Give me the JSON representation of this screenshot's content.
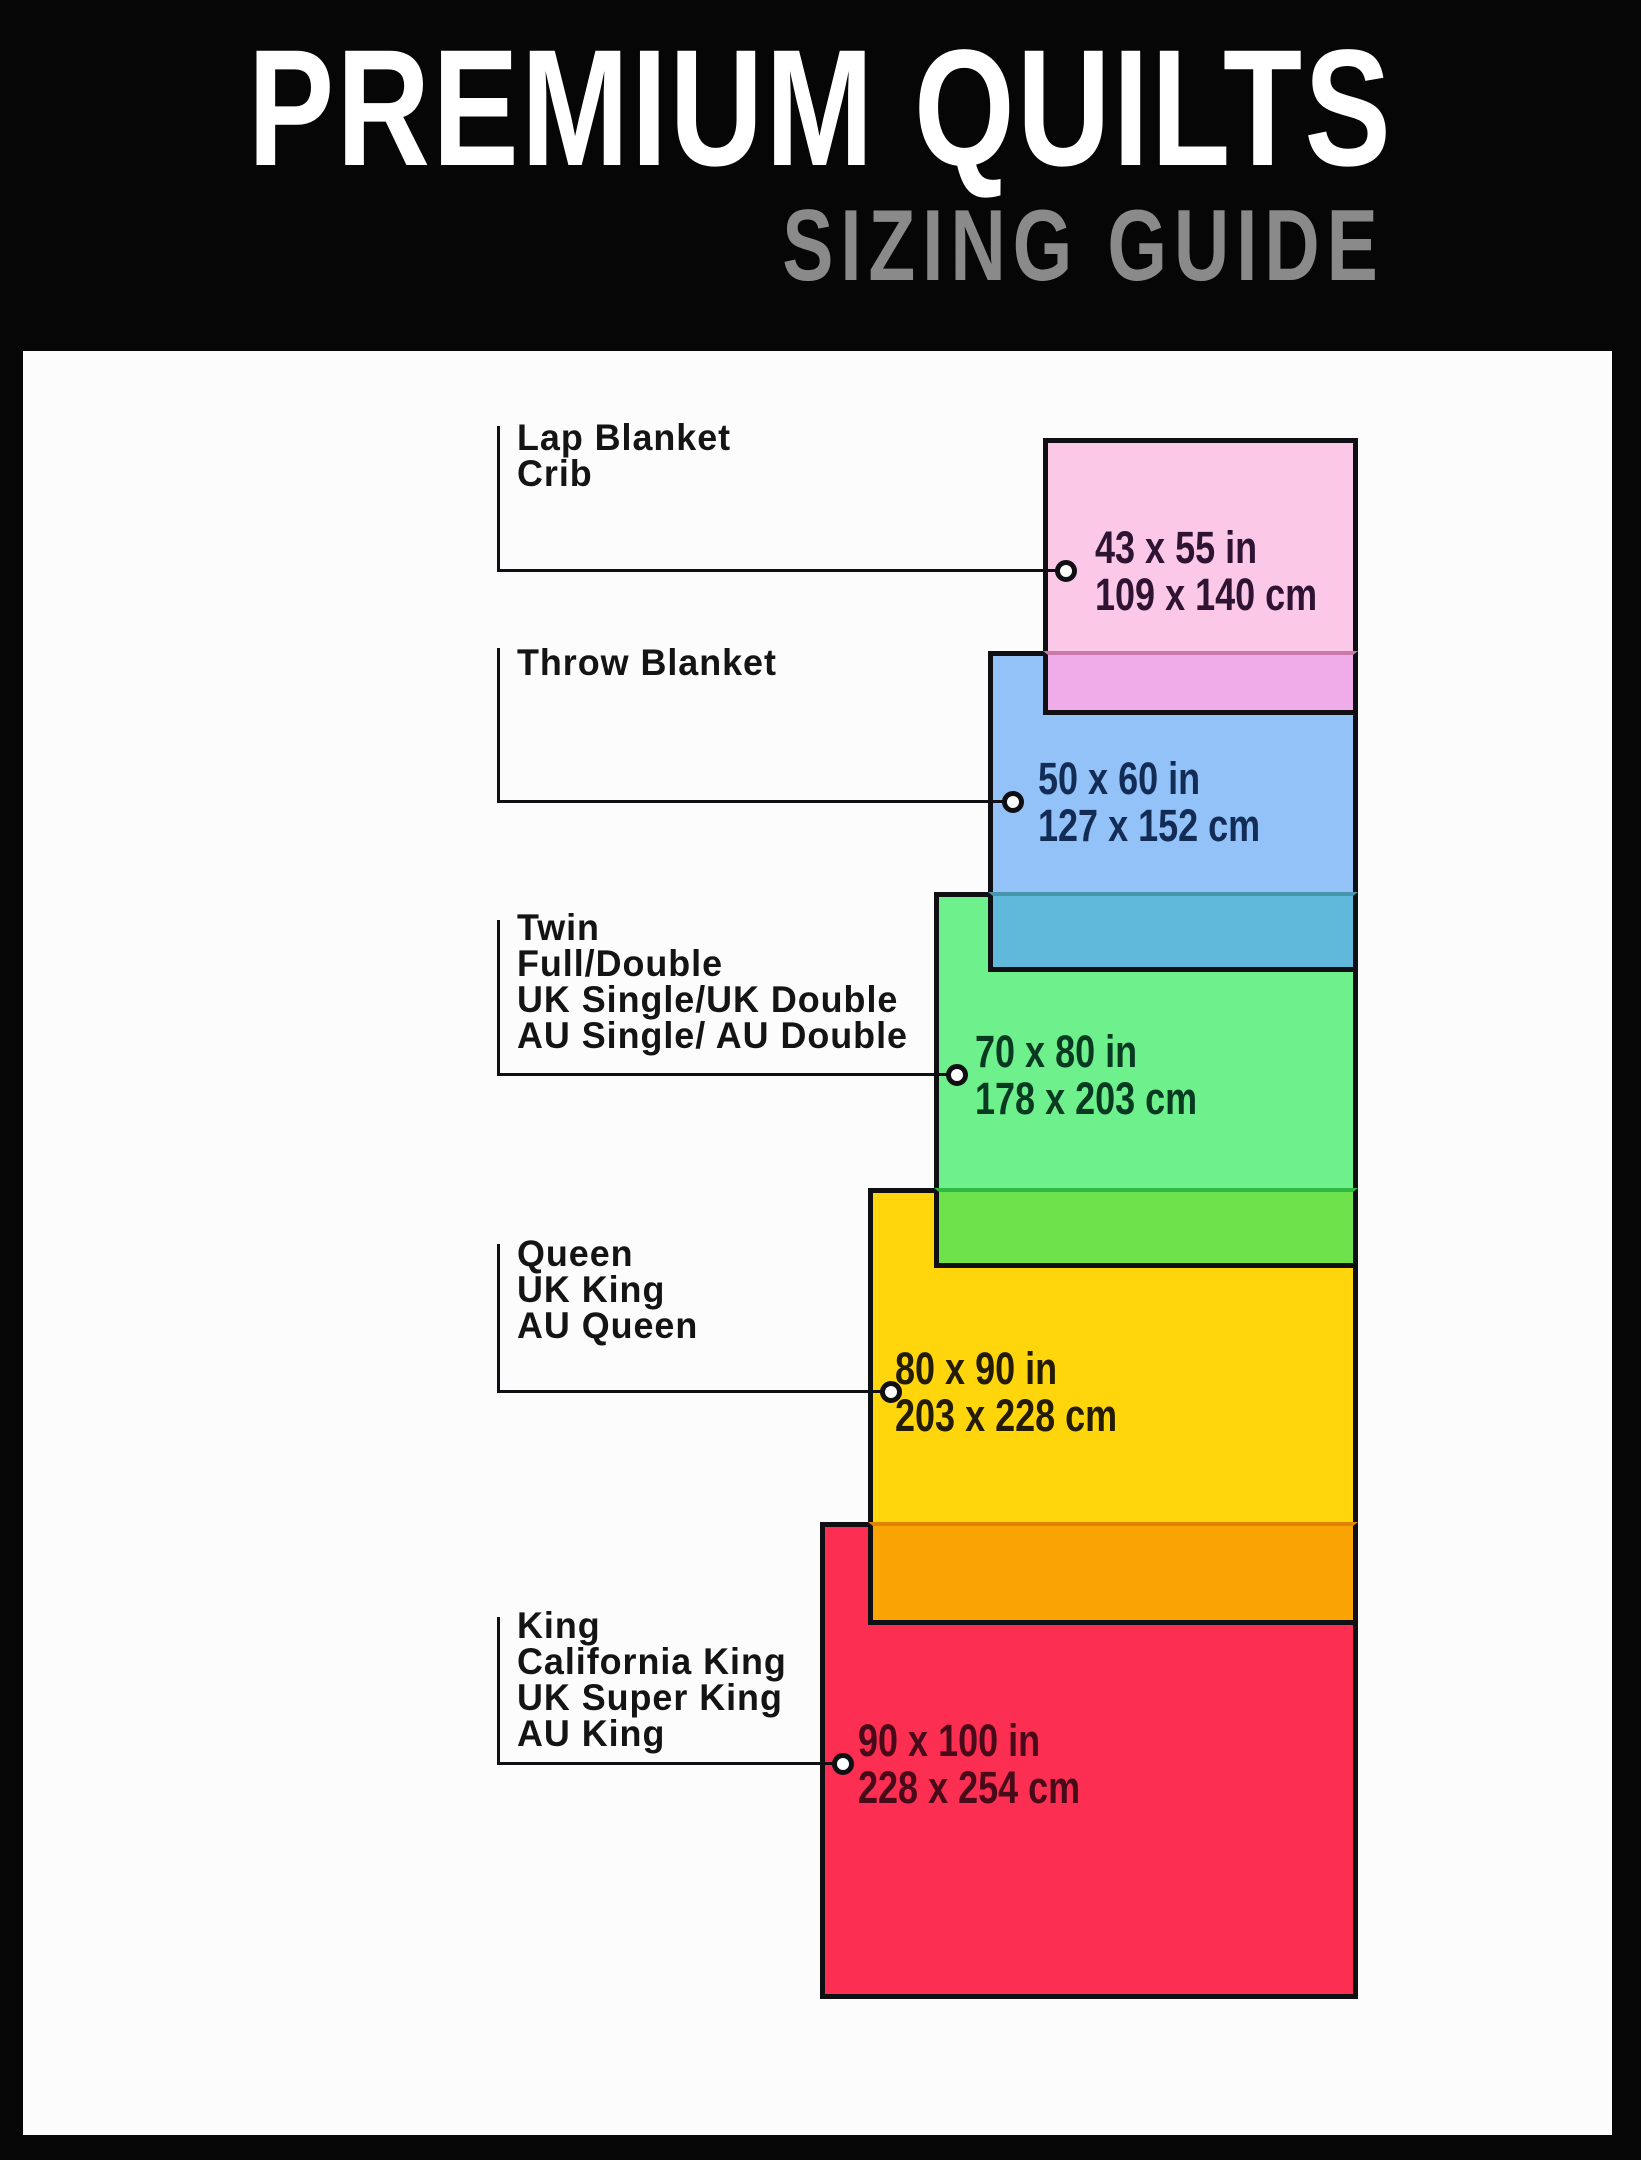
{
  "header": {
    "title": "PREMIUM QUILTS",
    "subtitle": "SIZING GUIDE"
  },
  "colors": {
    "background": "#060606",
    "panel": "#fcfcfc",
    "outline": "#101014",
    "title_text": "#ffffff",
    "subtitle_text": "#8a8a8a",
    "label_text": "#141414"
  },
  "sizes": [
    {
      "names": [
        "Lap Blanket",
        "Crib"
      ],
      "inches": "43 x 55 in",
      "cm": "109 x 140 cm",
      "fill": "#fbc8e7",
      "text_color": "#2f1333"
    },
    {
      "names": [
        "Throw Blanket"
      ],
      "inches": "50 x 60 in",
      "cm": "127 x 152 cm",
      "fill": "#92c2f8",
      "text_color": "#132c55",
      "overlap_fill": "#f0abe9",
      "overlap_line": "#c979ac"
    },
    {
      "names": [
        "Twin",
        "Full/Double",
        "UK Single/UK Double",
        "AU Single/ AU Double"
      ],
      "inches": "70 x 80 in",
      "cm": "178 x 203 cm",
      "fill": "#6ef08d",
      "text_color": "#083a21",
      "overlap_fill": "#60b8da",
      "overlap_line": "#4794ad"
    },
    {
      "names": [
        "Queen",
        "UK King",
        "AU Queen"
      ],
      "inches": "80 x 90 in",
      "cm": "203 x 228 cm",
      "fill": "#ffd60b",
      "text_color": "#231c02",
      "overlap_fill": "#6ee24b",
      "overlap_line": "#2eb944"
    },
    {
      "names": [
        "King",
        "California King",
        "UK Super King",
        "AU King"
      ],
      "inches": "90 x 100 in",
      "cm": "228 x 254 cm",
      "fill": "#fc2e51",
      "text_color": "#470a18",
      "overlap_fill": "#f9a403",
      "overlap_line": "#e08206"
    }
  ]
}
